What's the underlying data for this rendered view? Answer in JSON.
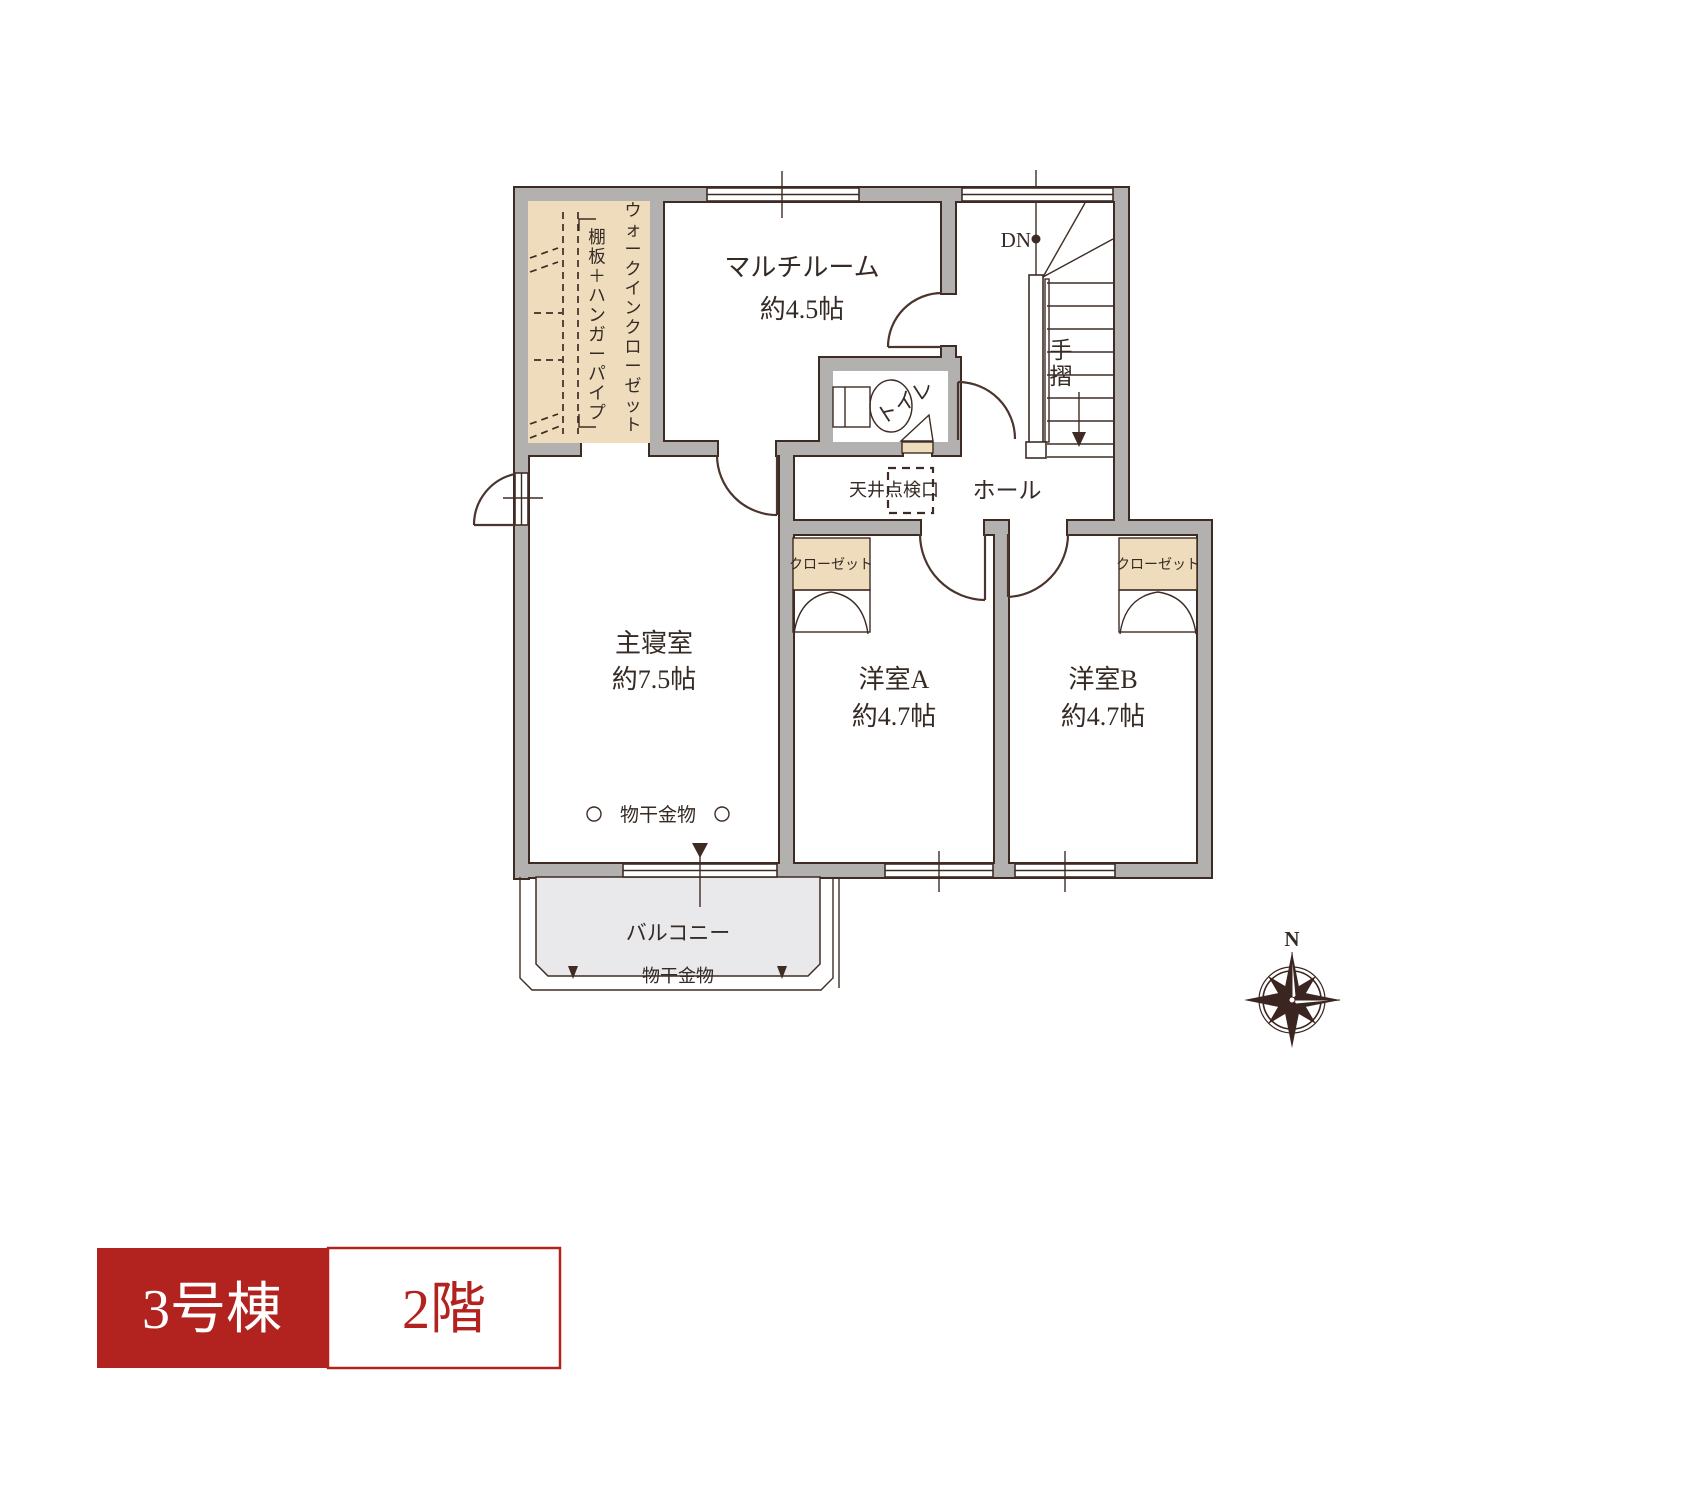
{
  "colors": {
    "wall_gray": "#b3b1af",
    "outline_brown": "#3e2c24",
    "closet_tan": "#eedcbd",
    "balcony_gray": "#e9e9eb",
    "accent_red": "#b2231f",
    "text_dark": "#352a24"
  },
  "plan": {
    "wic": {
      "shelf_label": "棚板＋ハンガーパイプ",
      "name": "ウォークインクローゼット"
    },
    "multiroom": {
      "name": "マルチルーム",
      "size": "約4.5帖"
    },
    "toilet": {
      "name": "トイレ"
    },
    "stairs": {
      "down_label": "DN",
      "handrail_label": "手摺"
    },
    "hall": {
      "name": "ホール",
      "ceiling_hatch_label": "天井点検口"
    },
    "master": {
      "name": "主寝室",
      "size": "約7.5帖",
      "laundry_label": "物干金物"
    },
    "room_a": {
      "name": "洋室A",
      "size": "約4.7帖",
      "closet_label": "クローゼット"
    },
    "room_b": {
      "name": "洋室B",
      "size": "約4.7帖",
      "closet_label": "クローゼット"
    },
    "balcony": {
      "name": "バルコニー",
      "laundry_label": "物干金物"
    },
    "compass": {
      "north_label": "N"
    }
  },
  "footer": {
    "building_label": "3号棟",
    "floor_label": "2階"
  }
}
